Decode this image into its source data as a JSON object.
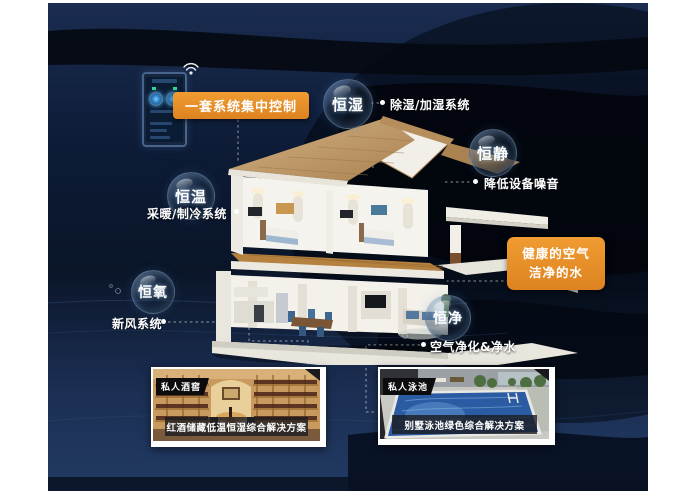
{
  "colors": {
    "accent_orange": "#e8912d",
    "background_navy": "#0d1a33",
    "background_bottom": "#1e3156",
    "swoosh_dark": "#04070e",
    "text_white": "#ffffff"
  },
  "control_panel": {
    "device": "smart-home-wall-controller",
    "wifi_icon": "wifi",
    "label": "一套系统集中控制"
  },
  "bubbles": [
    {
      "id": "heng-shi",
      "label": "恒湿",
      "annotation": "除湿/加湿系统"
    },
    {
      "id": "heng-jing-quiet",
      "label": "恒静",
      "annotation": "降低设备噪音"
    },
    {
      "id": "heng-wen",
      "label": "恒温",
      "annotation": "采暖/制冷系统"
    },
    {
      "id": "heng-yang",
      "label": "恒氧",
      "annotation": "新风系统"
    },
    {
      "id": "heng-jing-clean",
      "label": "恒净",
      "annotation": "空气净化&净水"
    }
  ],
  "highlight_box": {
    "line1": "健康的空气",
    "line2": "洁净的水"
  },
  "cards": [
    {
      "tag": "私人酒窖",
      "caption": "红酒储藏低温恒湿综合解决方案",
      "image": "wine-cellar-photo"
    },
    {
      "tag": "私人泳池",
      "caption": "别墅泳池绿色综合解决方案",
      "image": "swimming-pool-photo"
    }
  ],
  "illustration": "two-story-cutaway-smart-house"
}
